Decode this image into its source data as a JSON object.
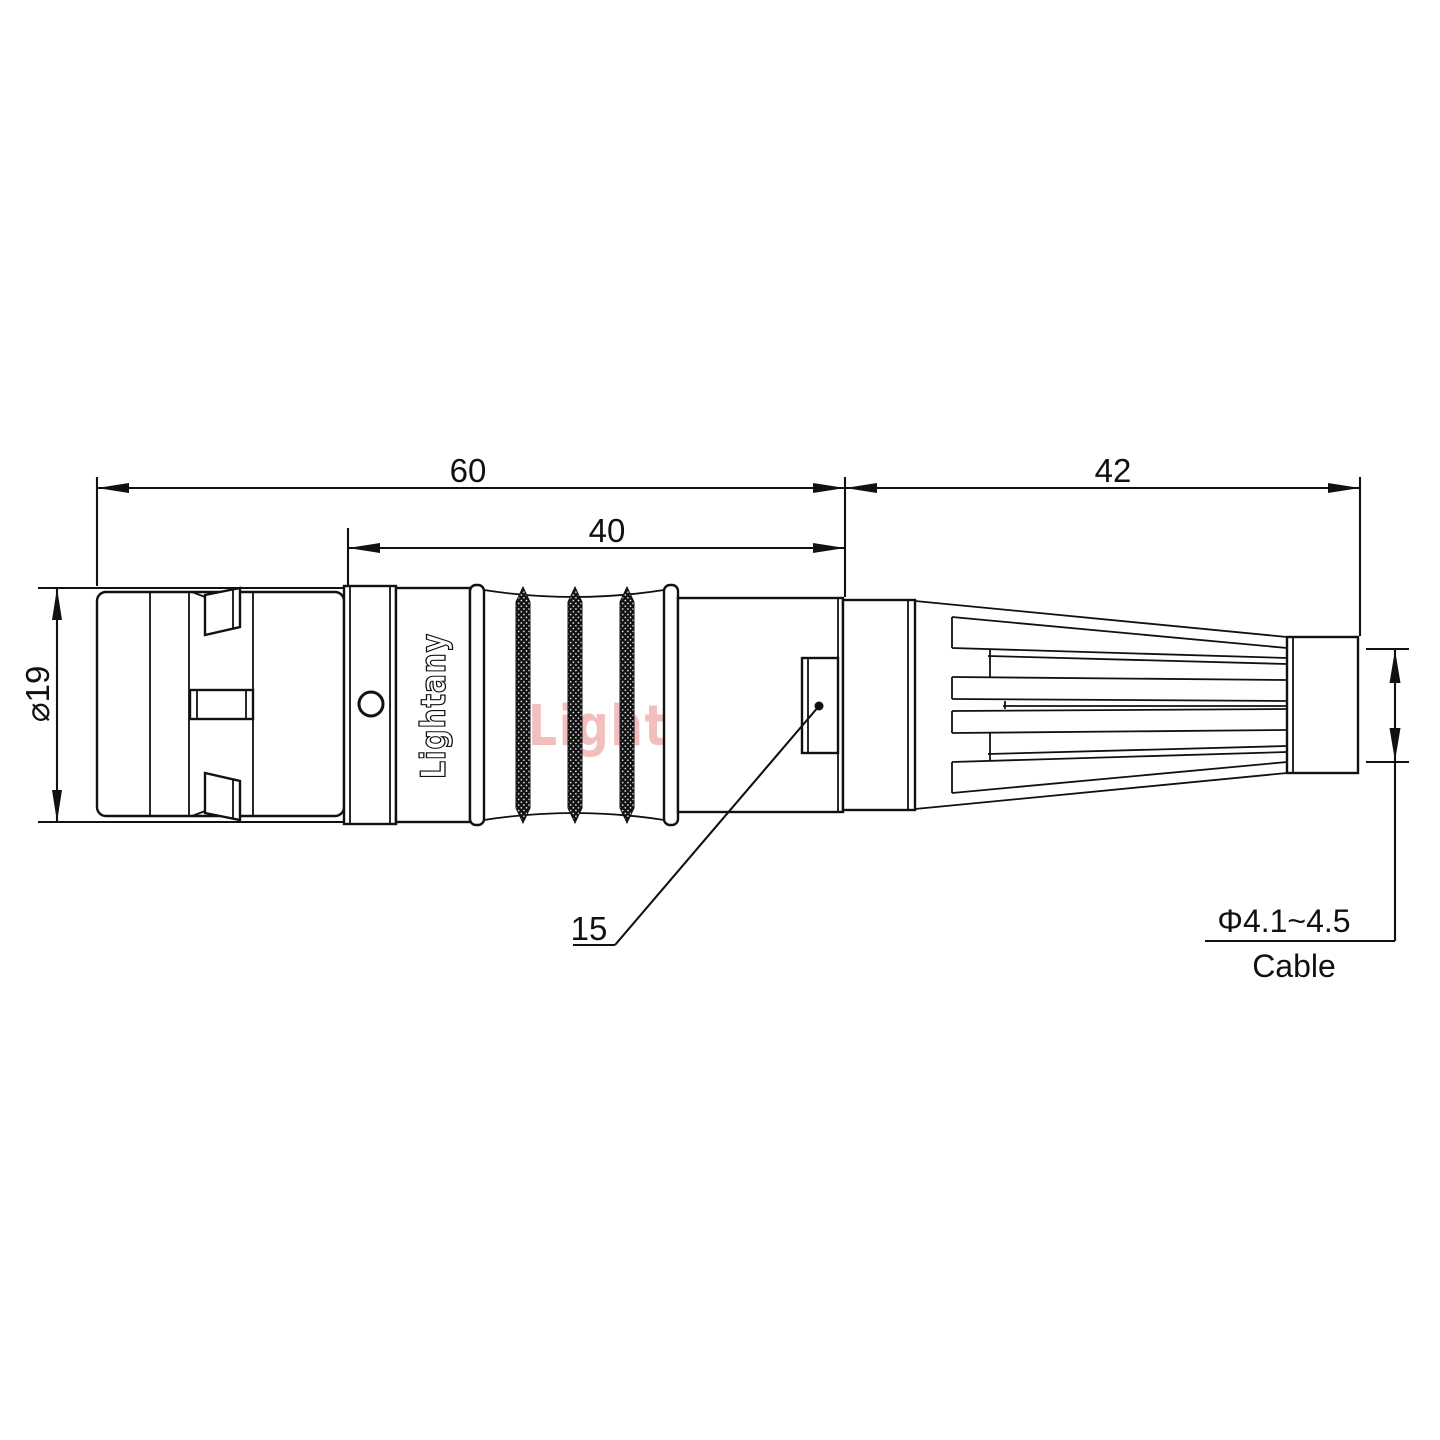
{
  "drawing": {
    "dimensions": {
      "overall_length": "60",
      "grip_length": "40",
      "rear_length": "42",
      "shell_diameter": "⌀19",
      "window_detail": "15",
      "cable_diameter_range": "Φ4.1~4.5",
      "cable_caption": "Cable"
    },
    "branding": {
      "engraving": "Lightany",
      "watermark": "Lightany"
    },
    "colors": {
      "line": "#111111",
      "watermark_pink": "#f2b3b3",
      "background": "#ffffff"
    }
  }
}
